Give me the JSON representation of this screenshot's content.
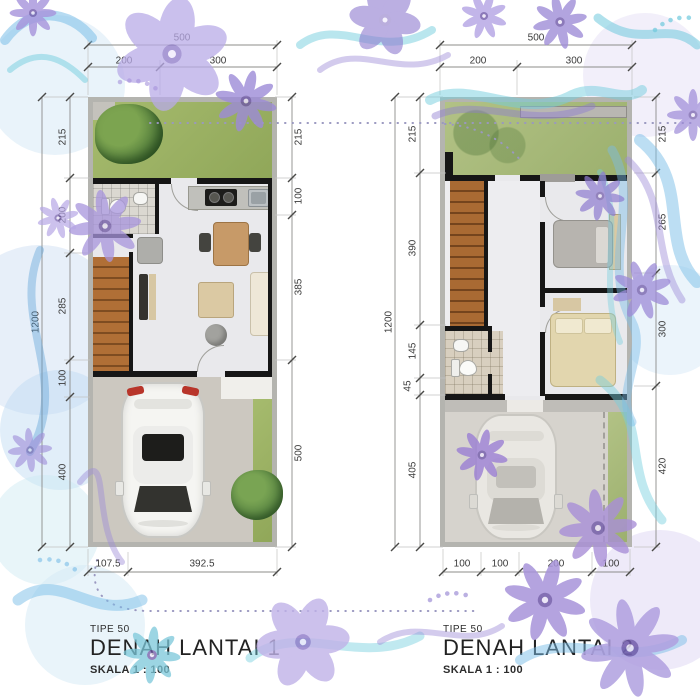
{
  "plans": {
    "floor1": {
      "type_label": "TIPE 50",
      "title": "DENAH LANTAI 1",
      "scale_label": "SKALA 1 : 100",
      "dims": {
        "top_total": "500",
        "top_segments": [
          "200",
          "300"
        ],
        "left_total": "1200",
        "left_segments": [
          "215",
          "200",
          "285",
          "100",
          "400"
        ],
        "right_segments": [
          "215",
          "100",
          "385",
          "500"
        ],
        "bottom_segments": [
          "107.5",
          "392.5"
        ]
      }
    },
    "floor2": {
      "type_label": "TIPE 50",
      "title": "DENAH LANTAI 2",
      "scale_label": "SKALA 1 : 100",
      "dims": {
        "top_total": "500",
        "top_segments": [
          "200",
          "300"
        ],
        "left_total": "1200",
        "left_segments": [
          "215",
          "390",
          "145",
          "45",
          "405"
        ],
        "right_segments": [
          "215",
          "265",
          "300",
          "420"
        ],
        "bottom_segments": [
          "100",
          "100",
          "200",
          "100"
        ]
      }
    }
  },
  "colors": {
    "accent_purple": "#9d8bd8",
    "accent_lavender": "#b9abe8",
    "accent_blue": "#7abde8",
    "accent_teal": "#74cede",
    "grass": "#9cb264",
    "wood_stairs": "#b06f36",
    "wall": "#161616",
    "concrete": "#ccc8c0",
    "dimension_text": "#3a3a3a"
  }
}
